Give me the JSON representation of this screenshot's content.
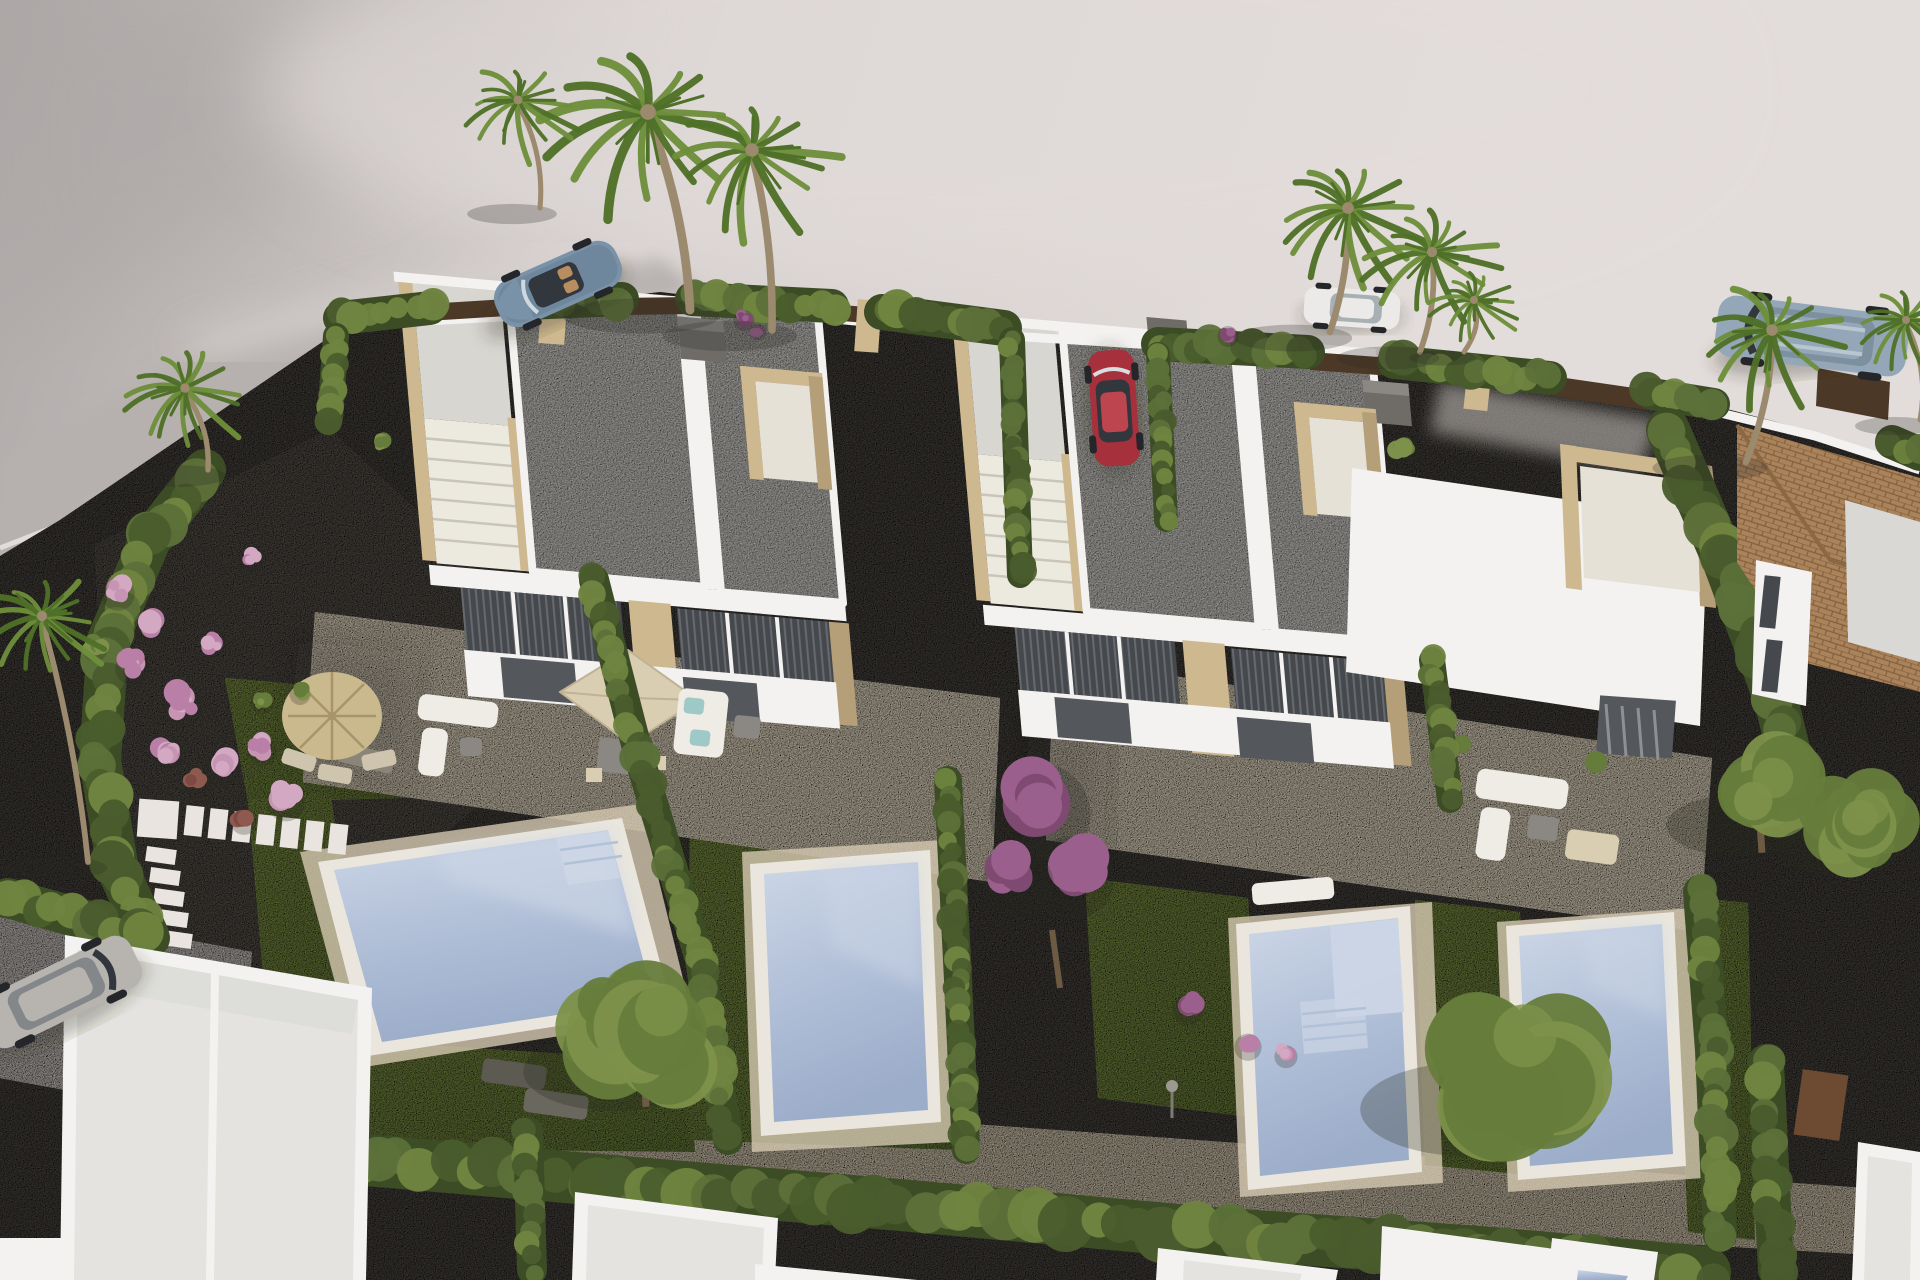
{
  "meta": {
    "kind": "3d-architectural-render",
    "description": "Aerial 3D visualisation of a new-build residential development: two modern white duplex villas, each unit with private lawn, swimming pool and cream tiled terrace, separated by cypress hedges, with bare light-grey terrain and an access road around the plot, parked cars, palm trees and neighbouring houses along the bottom edge.",
    "image_size": {
      "width": 1920,
      "height": 1280
    },
    "visible_text": []
  },
  "palette": {
    "terrainMid": "#d5cfcd",
    "terrainLight": "#e2dcda",
    "terrainDark": "#aca7a6",
    "roadGrey": "#b6b1af",
    "curbLight": "#e9e4e0",
    "gravelDark": "#4e4a45",
    "gravelMid": "#5a554f",
    "pathLight": "#d3c7b0",
    "driveLight": "#c8c3bf",
    "grassMid": "#6d8040",
    "grassLight": "#7f9148",
    "grassDark": "#55682f",
    "hedge1": "#5c7039",
    "hedge2": "#6f8440",
    "hedge3": "#4a5c2d",
    "hedgeDark": "#3c4c24",
    "wallWhite": "#f3f2f0",
    "wallShade": "#d9d8d5",
    "roof": "#d8d6d1",
    "roofShade": "#c2c0bb",
    "stone": "#cdb88f",
    "stoneDark": "#b49f78",
    "stairTread": "#ece9df",
    "stairLine": "#c9c5b8",
    "terrace": "#e3d8c2",
    "terraceShade": "#d4c8b0",
    "poolCoping": "#eae6dd",
    "waterLight": "#ccd6e6",
    "waterMid": "#b2c0d8",
    "waterDeep": "#9cadca",
    "glassDark": "#45494e",
    "doorDark": "#54585d",
    "mullion": "#f4f3f1",
    "fenceBrown": "#4c3827",
    "pergolaBrown": "#6d4a32",
    "tileRoof": "#aa835b",
    "tileLine": "#82603f",
    "chimneyGrey": "#6f6c68",
    "chimneyTop": "#8b8884",
    "palmGreen1": "#6d8f3a",
    "palmGreen2": "#4f7028",
    "palmTrunk": "#9b8a6d",
    "treeGreen1": "#667c3b",
    "treeGreen2": "#7d914a",
    "treeTrunk": "#6d5a42",
    "flowerPink1": "#c795b4",
    "flowerPink2": "#b97fa6",
    "flowerPink3": "#d2a8c2",
    "flowerRed1": "#8e5a50",
    "flowerRed2": "#7c4a42",
    "flowerPurple1": "#9a5f8c",
    "flowerPurple2": "#7f4a72",
    "umbrellaStraw": "#cbb98e",
    "umbrellaRib": "#a8936a",
    "parasolBeige": "#d9cdb2",
    "parasolEdge": "#c0b294",
    "sofaWhite": "#efece6",
    "cushionAqua": "#9fc9c6",
    "tableGrey": "#8b8883",
    "carBlue": "#7a92a8",
    "carBlueDark": "#5d7489",
    "carRed": "#a6303b",
    "carRedRoof": "#bc4550",
    "carWhite": "#ebeae8",
    "carSilver": "#b7b4b0",
    "carSuv": "#93a7b8",
    "glassCar": "#31373c",
    "seatTan": "#b98d5f",
    "wheelDark": "#24262a"
  },
  "scene": {
    "ground": [
      "bare light grey terrain (upper area)",
      "curved grey access road top-left",
      "dark gravel plot ground",
      "cream tiled terraces",
      "lawns",
      "light stone footpath along bottom",
      "dark gravel street at bottom edge"
    ],
    "buildings": [
      {
        "name": "left-duplex-villa",
        "style": "modern flat-roof white duplex",
        "features": [
          "two grey roof slabs with white parapets",
          "front-left roof access stair with beige stone parapet",
          "beige stone roof terrace block at right",
          "two dark grey chimney cubes",
          "two-storey dark glazing with white mullions",
          "beige stone pilasters"
        ]
      },
      {
        "name": "right-duplex-villa",
        "style": "modern flat-roof white duplex",
        "features": [
          "two grey roof slabs with white parapets",
          "front-left roof access stair",
          "beige stone parapet blocks",
          "east wing with beige-walled roof terrace",
          "dark grey chimney cube",
          "dark glazing with shutters"
        ]
      },
      {
        "name": "neighbour-house-tiled-roof",
        "style": "clay tile roof house, right edge"
      },
      {
        "name": "bottom-row-houses",
        "style": "white flat-roof houses under construction along bottom edge"
      }
    ],
    "pools": [
      {
        "name": "big-pool-left-unit",
        "shape": "wide rotated square, steps top-right"
      },
      {
        "name": "narrow-pool-left-duplex-unit2",
        "shape": "narrow rectangle"
      },
      {
        "name": "pool-right-duplex-unit1",
        "shape": "narrow rectangle with wide steps"
      },
      {
        "name": "pool-right-duplex-unit2",
        "shape": "narrow rectangle"
      }
    ],
    "vehicles": [
      {
        "name": "blue-convertible",
        "color_key": "carBlue",
        "location": "road top-left"
      },
      {
        "name": "white-estate-car",
        "color_key": "carWhite",
        "location": "behind palms top-right"
      },
      {
        "name": "steel-blue-suv",
        "color_key": "carSuv",
        "location": "far right, above tiled-roof house"
      },
      {
        "name": "red-hatchback",
        "color_key": "carRed",
        "location": "central driveway between villas"
      },
      {
        "name": "silver-hatchback",
        "color_key": "carSilver",
        "location": "bottom-left driveway"
      }
    ],
    "vegetation": [
      "tall fan palms (top centre, top right, far right, left)",
      "cypress hedge rows and columns",
      "round green trees beside pools",
      "magenta bougainvillea",
      "pink flowering shrubs in left gravel garden"
    ],
    "furniture": [
      "square beige parasol with dining set (left terrace)",
      "round straw umbrella with chairs (left garden)",
      "white corner sofas with aqua cushions",
      "sun loungers near pools",
      "stepping-stone path"
    ]
  }
}
